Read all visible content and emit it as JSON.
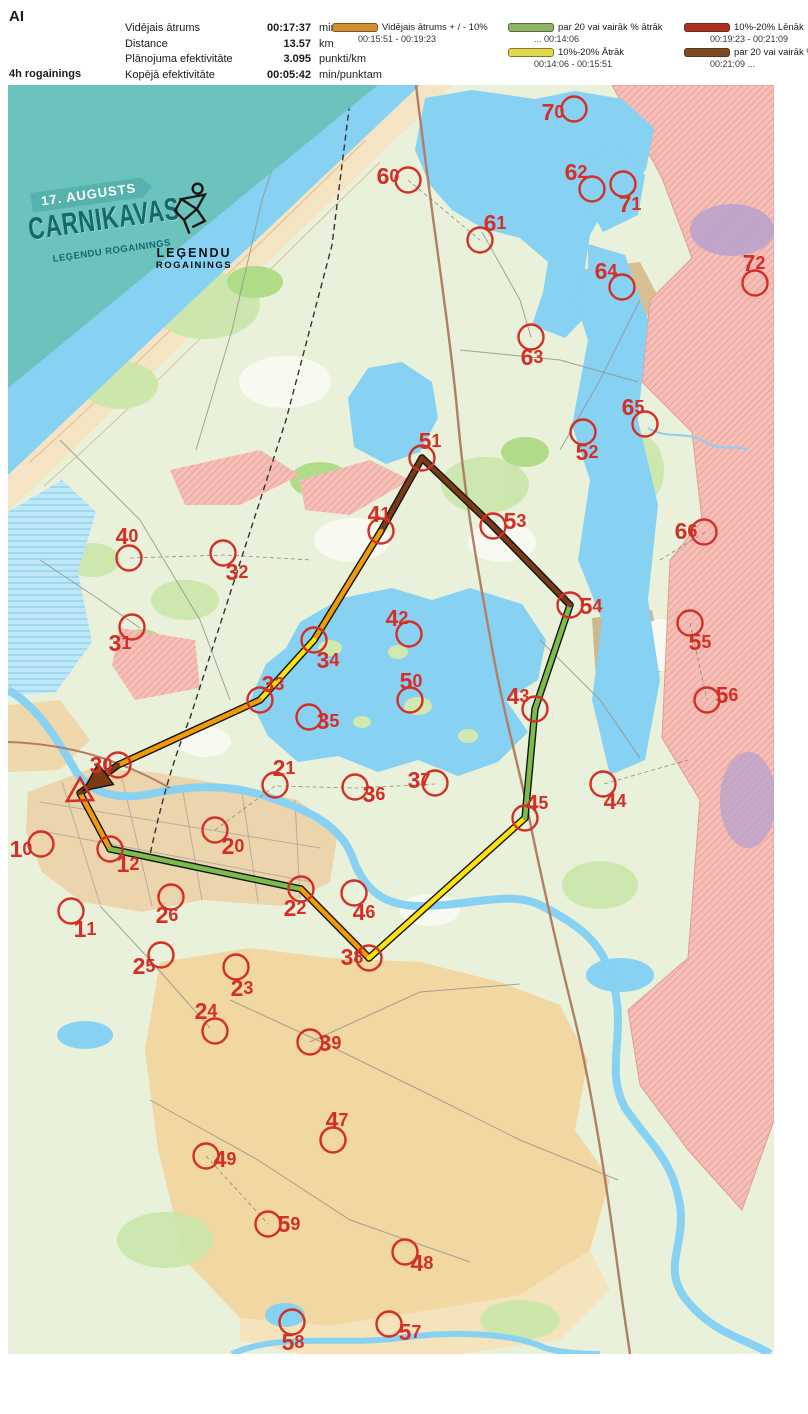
{
  "header": {
    "title": "AI",
    "info_lines": [
      "4h rogainings",
      "Punkti: 42",
      "03:59:06"
    ],
    "stats": [
      {
        "label": "Vidējais ātrums",
        "value": "00:17:37",
        "unit": "min/km"
      },
      {
        "label": "Distance",
        "value": "13.57",
        "unit": "km"
      },
      {
        "label": "Plānojuma efektivitāte",
        "value": "3.095",
        "unit": "punkti/km"
      },
      {
        "label": "Kopējā efektivitāte",
        "value": "00:05:42",
        "unit": "min/punktam"
      }
    ],
    "legend_columns": [
      [
        {
          "key": "avg",
          "color": "#CE8F33",
          "label": "Vidējais ātrums + / - 10%",
          "range": "00:15:51   -   00:19:23"
        }
      ],
      [
        {
          "key": "fast20",
          "color": "#8CB469",
          "label": "par 20 vai vairāk % ātrāk",
          "range": "...   00:14:06"
        },
        {
          "key": "fast10",
          "color": "#E3D94F",
          "label": "10%-20% Ātrāk",
          "range": "00:14:06   -   00:15:51"
        }
      ],
      [
        {
          "key": "slow10",
          "color": "#AC2F26",
          "label": "10%-20% Lēnāk",
          "range": "00:19:23   - 00:21:09"
        },
        {
          "key": "slow20",
          "color": "#7A4A26",
          "label": "par 20 vai vairāk % lēnāk",
          "range": "00:21:09   ..."
        }
      ]
    ]
  },
  "banner": {
    "ribbon": "17. AUGUSTS",
    "title": "CARNIKAVAS",
    "subtitle": "LEĢENDU ROGAININGS",
    "logo_top": "LEĢENDU",
    "logo_bottom": "ROGAININGS"
  },
  "map": {
    "marker_color": "#D42F26",
    "route_colors": {
      "avg": "#F09A08",
      "fast20": "#7ABD4A",
      "fast10": "#FFE20A",
      "slow10": "#B22B22",
      "slow20": "#7A3B14"
    },
    "start": {
      "point": [
        80,
        793
      ],
      "triangle": "80,778 67,801 93,800"
    },
    "controls": [
      {
        "id": "10",
        "cx": 41,
        "cy": 844,
        "lx": 21,
        "ly": 849
      },
      {
        "id": "11",
        "cx": 71,
        "cy": 911,
        "lx": 85,
        "ly": 929
      },
      {
        "id": "12",
        "cx": 110,
        "cy": 849,
        "lx": 128,
        "ly": 864
      },
      {
        "id": "20",
        "cx": 215,
        "cy": 830,
        "lx": 233,
        "ly": 846
      },
      {
        "id": "21",
        "cx": 275,
        "cy": 785,
        "lx": 284,
        "ly": 768
      },
      {
        "id": "22",
        "cx": 301,
        "cy": 889,
        "lx": 295,
        "ly": 908
      },
      {
        "id": "23",
        "cx": 236,
        "cy": 967,
        "lx": 242,
        "ly": 988
      },
      {
        "id": "24",
        "cx": 215,
        "cy": 1031,
        "lx": 206,
        "ly": 1011
      },
      {
        "id": "25",
        "cx": 161,
        "cy": 955,
        "lx": 144,
        "ly": 966
      },
      {
        "id": "26",
        "cx": 171,
        "cy": 897,
        "lx": 167,
        "ly": 915
      },
      {
        "id": "30",
        "cx": 118,
        "cy": 765,
        "lx": 101,
        "ly": 765
      },
      {
        "id": "31",
        "cx": 132,
        "cy": 627,
        "lx": 120,
        "ly": 643
      },
      {
        "id": "32",
        "cx": 223,
        "cy": 553,
        "lx": 237,
        "ly": 572
      },
      {
        "id": "33",
        "cx": 260,
        "cy": 700,
        "lx": 273,
        "ly": 684
      },
      {
        "id": "34",
        "cx": 314,
        "cy": 640,
        "lx": 328,
        "ly": 660
      },
      {
        "id": "35",
        "cx": 309,
        "cy": 717,
        "lx": 328,
        "ly": 721
      },
      {
        "id": "36",
        "cx": 355,
        "cy": 787,
        "lx": 374,
        "ly": 794
      },
      {
        "id": "37",
        "cx": 435,
        "cy": 783,
        "lx": 419,
        "ly": 780
      },
      {
        "id": "38",
        "cx": 369,
        "cy": 958,
        "lx": 352,
        "ly": 957
      },
      {
        "id": "39",
        "cx": 310,
        "cy": 1042,
        "lx": 330,
        "ly": 1043
      },
      {
        "id": "40",
        "cx": 129,
        "cy": 558,
        "lx": 127,
        "ly": 536
      },
      {
        "id": "41",
        "cx": 381,
        "cy": 531,
        "lx": 379,
        "ly": 514
      },
      {
        "id": "42",
        "cx": 409,
        "cy": 634,
        "lx": 397,
        "ly": 618
      },
      {
        "id": "43",
        "cx": 535,
        "cy": 709,
        "lx": 518,
        "ly": 696
      },
      {
        "id": "44",
        "cx": 603,
        "cy": 784,
        "lx": 615,
        "ly": 801
      },
      {
        "id": "45",
        "cx": 525,
        "cy": 818,
        "lx": 537,
        "ly": 803
      },
      {
        "id": "46",
        "cx": 354,
        "cy": 893,
        "lx": 364,
        "ly": 912
      },
      {
        "id": "47",
        "cx": 333,
        "cy": 1140,
        "lx": 337,
        "ly": 1120
      },
      {
        "id": "48",
        "cx": 405,
        "cy": 1252,
        "lx": 422,
        "ly": 1263
      },
      {
        "id": "49",
        "cx": 206,
        "cy": 1156,
        "lx": 225,
        "ly": 1159
      },
      {
        "id": "50",
        "cx": 410,
        "cy": 700,
        "lx": 411,
        "ly": 681
      },
      {
        "id": "51",
        "cx": 422,
        "cy": 458,
        "lx": 430,
        "ly": 441
      },
      {
        "id": "52",
        "cx": 583,
        "cy": 432,
        "lx": 587,
        "ly": 452
      },
      {
        "id": "53",
        "cx": 493,
        "cy": 526,
        "lx": 515,
        "ly": 521
      },
      {
        "id": "54",
        "cx": 570,
        "cy": 605,
        "lx": 591,
        "ly": 606
      },
      {
        "id": "55",
        "cx": 690,
        "cy": 623,
        "lx": 700,
        "ly": 642
      },
      {
        "id": "56",
        "cx": 707,
        "cy": 700,
        "lx": 727,
        "ly": 695
      },
      {
        "id": "57",
        "cx": 389,
        "cy": 1324,
        "lx": 410,
        "ly": 1332
      },
      {
        "id": "58",
        "cx": 292,
        "cy": 1322,
        "lx": 293,
        "ly": 1342
      },
      {
        "id": "59",
        "cx": 268,
        "cy": 1224,
        "lx": 289,
        "ly": 1224
      },
      {
        "id": "60",
        "cx": 408,
        "cy": 180,
        "lx": 388,
        "ly": 176
      },
      {
        "id": "61",
        "cx": 480,
        "cy": 240,
        "lx": 495,
        "ly": 223
      },
      {
        "id": "62",
        "cx": 592,
        "cy": 189,
        "lx": 576,
        "ly": 172
      },
      {
        "id": "63",
        "cx": 531,
        "cy": 337,
        "lx": 532,
        "ly": 357
      },
      {
        "id": "64",
        "cx": 622,
        "cy": 287,
        "lx": 606,
        "ly": 271
      },
      {
        "id": "65",
        "cx": 645,
        "cy": 424,
        "lx": 633,
        "ly": 407
      },
      {
        "id": "66",
        "cx": 704,
        "cy": 532,
        "lx": 686,
        "ly": 531
      },
      {
        "id": "70",
        "cx": 574,
        "cy": 109,
        "lx": 553,
        "ly": 112
      },
      {
        "id": "71",
        "cx": 623,
        "cy": 184,
        "lx": 630,
        "ly": 204
      },
      {
        "id": "72",
        "cx": 755,
        "cy": 283,
        "lx": 754,
        "ly": 263
      }
    ],
    "route": [
      {
        "from": "start",
        "to": "12",
        "cat": "avg"
      },
      {
        "from": "12",
        "to": "22",
        "cat": "fast20"
      },
      {
        "from": "22",
        "to": "38",
        "cat": "avg"
      },
      {
        "from": "38",
        "to": "45",
        "cat": "fast10"
      },
      {
        "from": "45",
        "to": "43",
        "cat": "fast20"
      },
      {
        "from": "43",
        "to": "54",
        "cat": "fast20"
      },
      {
        "from": "54",
        "to": "53",
        "cat": "slow20"
      },
      {
        "from": "53",
        "to": "51",
        "cat": "slow20"
      },
      {
        "from": "51",
        "to": "41",
        "cat": "slow20"
      },
      {
        "from": "41",
        "to": "34",
        "cat": "avg"
      },
      {
        "from": "34",
        "to": "33",
        "cat": "fast10"
      },
      {
        "from": "33",
        "to": "30",
        "cat": "avg"
      },
      {
        "from": "30",
        "to": "finish",
        "cat": "slow20",
        "arrow": true
      }
    ]
  }
}
